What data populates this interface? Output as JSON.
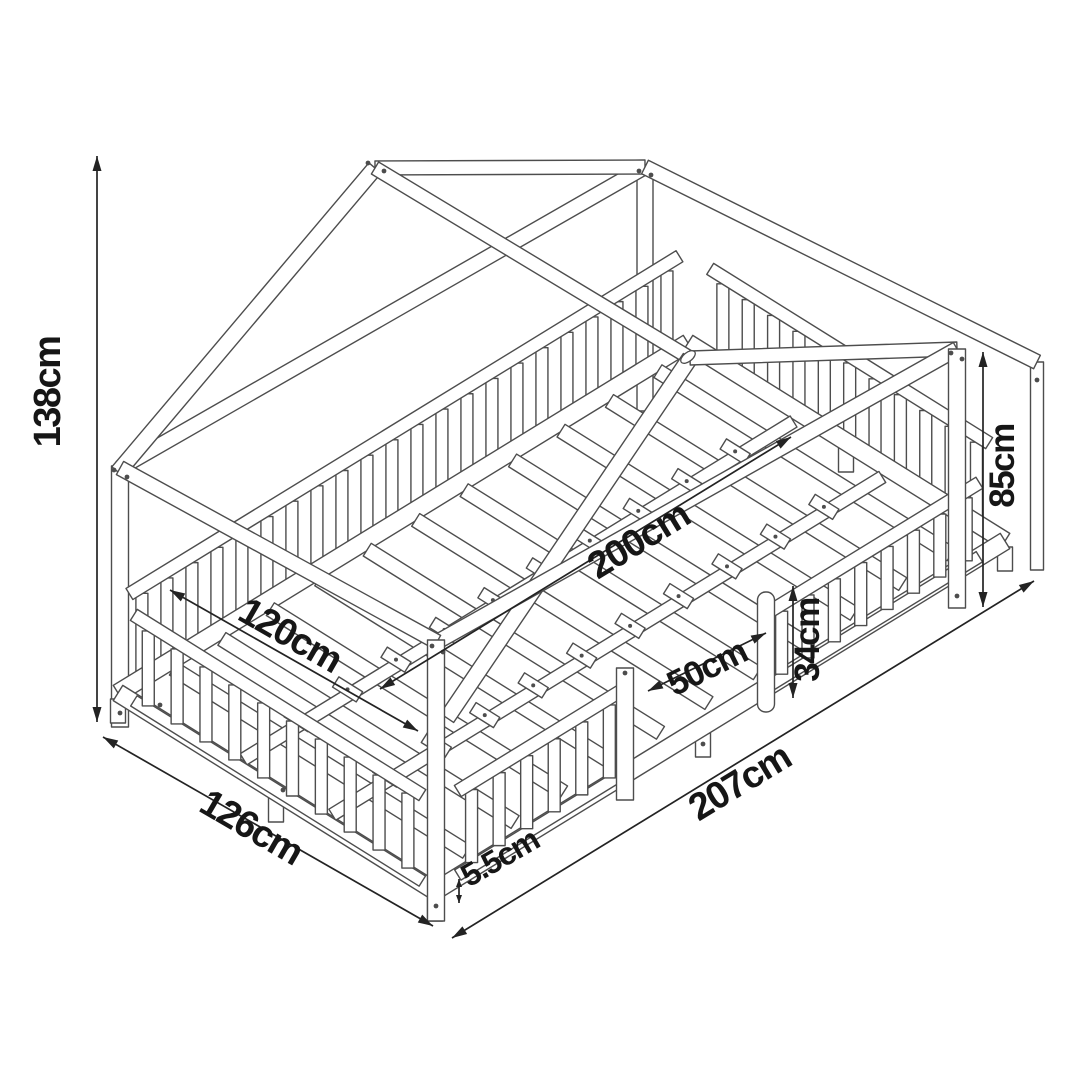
{
  "meta": {
    "type": "product-dimension-diagram",
    "subject": "house-frame kids bed with fall-protection rails and slatted base",
    "background": "#ffffff",
    "line_color": "#4d4d4d",
    "dim_color": "#232323",
    "text_color": "#161616"
  },
  "dimensions": [
    {
      "id": "total-height",
      "label": "138cm",
      "x1": 97,
      "y1": 156,
      "x2": 97,
      "y2": 722,
      "lx": 60,
      "ly": 392,
      "rot": -90,
      "fs": 38
    },
    {
      "id": "wall-height",
      "label": "85cm",
      "x1": 983,
      "y1": 352,
      "x2": 983,
      "y2": 607,
      "lx": 1014,
      "ly": 466,
      "rot": -90,
      "fs": 35
    },
    {
      "id": "inner-length",
      "label": "200cm",
      "x1": 380,
      "y1": 689,
      "x2": 791,
      "y2": 437,
      "lx": 645,
      "ly": 551,
      "rot": -31.5,
      "fs": 38
    },
    {
      "id": "inner-width",
      "label": "120cm",
      "x1": 170,
      "y1": 590,
      "x2": 418,
      "y2": 731,
      "lx": 284,
      "ly": 646,
      "rot": 29.8,
      "fs": 38
    },
    {
      "id": "entry-width",
      "label": "50cm",
      "x1": 648,
      "y1": 691,
      "x2": 766,
      "y2": 633,
      "lx": 712,
      "ly": 678,
      "rot": -26.5,
      "fs": 35
    },
    {
      "id": "rail-height",
      "label": "34cm",
      "x1": 793,
      "y1": 586,
      "x2": 793,
      "y2": 698,
      "lx": 819,
      "ly": 640,
      "rot": -90,
      "fs": 35
    },
    {
      "id": "outer-width",
      "label": "126cm",
      "x1": 103,
      "y1": 737,
      "x2": 433,
      "y2": 926,
      "lx": 245,
      "ly": 838,
      "rot": 30.2,
      "fs": 38
    },
    {
      "id": "outer-length",
      "label": "207cm",
      "x1": 452,
      "y1": 938,
      "x2": 1034,
      "y2": 581,
      "lx": 746,
      "ly": 793,
      "rot": -31.2,
      "fs": 38
    },
    {
      "id": "floor-clearance",
      "label": "5.5cm",
      "x1": 459,
      "y1": 879,
      "x2": 459,
      "y2": 903,
      "lx": 505,
      "ly": 867,
      "rot": -30,
      "fs": 32
    }
  ],
  "drawing": {
    "floor": {
      "L": [
        118,
        723
      ],
      "F": [
        435,
        921
      ],
      "R": [
        1005,
        571
      ],
      "B": [
        688,
        373
      ]
    },
    "posts": [
      {
        "name": "post-back-left",
        "top": [
          120,
          466
        ],
        "bot": [
          120,
          727
        ],
        "w": 17
      },
      {
        "name": "post-back-right",
        "top": [
          645,
          167
        ],
        "bot": [
          645,
          411
        ],
        "w": 16
      },
      {
        "name": "post-foot-far",
        "top": [
          1037,
          362
        ],
        "bot": [
          1037,
          570
        ],
        "w": 13
      },
      {
        "name": "post-front-left",
        "top": [
          436,
          640
        ],
        "bot": [
          436,
          921
        ],
        "w": 17
      },
      {
        "name": "post-front-right",
        "top": [
          957,
          349
        ],
        "bot": [
          957,
          608
        ],
        "w": 17
      }
    ],
    "plates": [
      {
        "name": "plate-head",
        "p1": [
          120,
          468
        ],
        "p2": [
          437,
          642
        ],
        "w": 15
      },
      {
        "name": "plate-back",
        "p1": [
          120,
          468
        ],
        "p2": [
          645,
          167
        ],
        "w": 15
      },
      {
        "name": "plate-foot",
        "p1": [
          645,
          167
        ],
        "p2": [
          1037,
          362
        ],
        "w": 15
      },
      {
        "name": "plate-front",
        "p1": [
          437,
          642
        ],
        "p2": [
          957,
          349
        ],
        "w": 15
      }
    ],
    "roof": {
      "back_rafter_left": {
        "p1": [
          118,
          472
        ],
        "p2": [
          375,
          168
        ],
        "w": 16
      },
      "back_rafter_right": {
        "p1": [
          375,
          168
        ],
        "p2": [
          645,
          167
        ],
        "w": 14
      },
      "ridge": {
        "p1": [
          375,
          168
        ],
        "p2": [
          690,
          358
        ],
        "w": 14
      },
      "front_rafter_left": {
        "p1": [
          447,
          718
        ],
        "p2": [
          690,
          358
        ],
        "w": 16
      },
      "front_rafter_right": {
        "p1": [
          690,
          358
        ],
        "p2": [
          957,
          349
        ],
        "w": 14
      }
    },
    "apex_back": [
      375,
      168
    ],
    "apex_front": [
      690,
      358
    ],
    "base": {
      "rail_lift": 30,
      "rail_w": 18,
      "slat_count": 11,
      "slat_t0": 0.075,
      "slat_t1": 0.925,
      "slat_w": 15,
      "slat_lift": 36,
      "long_rails": [
        0.36,
        0.64
      ],
      "long_rail_w": 13,
      "long_rail_lift": 28
    },
    "legs": [
      [
        118,
        723
      ],
      [
        276,
        822
      ],
      [
        435,
        921
      ],
      [
        703,
        757
      ],
      [
        846,
        472
      ],
      [
        1005,
        571
      ]
    ],
    "fences": [
      {
        "name": "fence-back",
        "edge": "L-B",
        "a": 0.02,
        "b": 0.985,
        "ht": 122,
        "hb": 26,
        "sp": 30
      },
      {
        "name": "fence-foot",
        "edge": "B-R",
        "a": 0.07,
        "b": 0.95,
        "ht": 118,
        "hb": 26,
        "sp": 31
      },
      {
        "name": "fence-head",
        "edge": "L-F",
        "a": 0.05,
        "b": 0.96,
        "ht": 118,
        "hb": 26,
        "sp": 33
      },
      {
        "name": "fence-front-left",
        "edge": "F-R",
        "a": 0.04,
        "b": 0.33,
        "ht": 116,
        "hb": 26,
        "sp": 32
      },
      {
        "name": "fence-front-right",
        "edge": "F-R",
        "a": 0.585,
        "b": 0.955,
        "ht": 104,
        "hb": 24,
        "sp": 30
      }
    ],
    "door": {
      "left_post": {
        "top": [
          625,
          668
        ],
        "bot": [
          625,
          800
        ],
        "w": 17
      },
      "round_post": {
        "top": [
          766,
          592
        ],
        "bot": [
          766,
          712
        ],
        "w": 17
      }
    },
    "screws": [
      [
        368,
        163
      ],
      [
        384,
        171
      ],
      [
        114,
        470
      ],
      [
        127,
        477
      ],
      [
        432,
        646
      ],
      [
        443,
        652
      ],
      [
        951,
        353
      ],
      [
        962,
        359
      ],
      [
        639,
        171
      ],
      [
        651,
        175
      ],
      [
        625,
        673
      ],
      [
        120,
        713
      ],
      [
        436,
        906
      ],
      [
        957,
        596
      ],
      [
        1037,
        380
      ],
      [
        283,
        790
      ],
      [
        160,
        705
      ],
      [
        703,
        744
      ]
    ],
    "slot_hole": {
      "cx": 688,
      "cy": 357,
      "rx": 4.5,
      "ry": 8.5,
      "rot": 52
    }
  }
}
